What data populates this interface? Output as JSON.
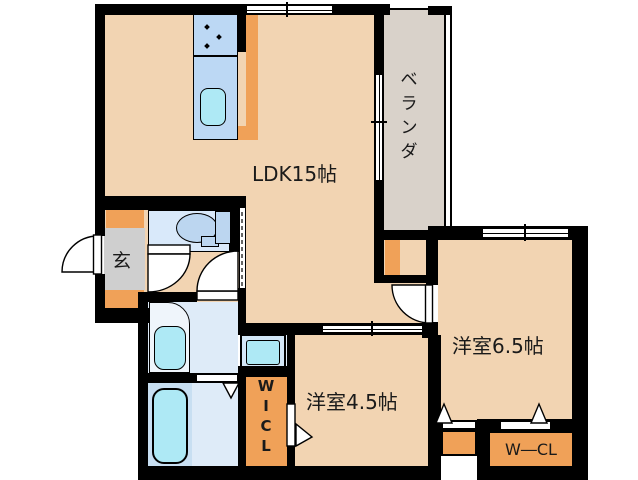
{
  "floorplan": {
    "rooms": {
      "ldk_label": "LDK15帖",
      "veranda_chars": [
        "ベ",
        "ラ",
        "ン",
        "ダ"
      ],
      "entrance_label": "玄",
      "room65_label": "洋室6.5帖",
      "room45_label": "洋室4.5帖",
      "wcl_label": "W―CL",
      "wicl_chars": [
        "W",
        "I",
        "C",
        "L"
      ]
    },
    "fixtures": [
      "kitchen-counter-with-sink",
      "toilet",
      "washbasin",
      "washing-machine-pan",
      "bathtub"
    ],
    "door_symbols": [
      "entrance-swing-door",
      "toilet-swing-door",
      "washroom-swing-door",
      "room65-swing-door",
      "wicl-folding-door",
      "bathroom-folding-door",
      "closet-folding-door-small",
      "closet-folding-door-wcl",
      "ldk-accordion-door"
    ],
    "window_symbols": [
      "ldk-top-window",
      "room65-top-window",
      "veranda-sliding-door",
      "ldk-room45-sliding-door"
    ]
  },
  "colors": {
    "floor_peach": "#F2D4B2",
    "closet_orange": "#F0A158",
    "kitchen_blue": "#BCD8F4",
    "fixture_cyan": "#AEE9F5",
    "wet_blue": "#DEEBF8",
    "veranda_gray": "#D9D2CA",
    "genkan_gray": "#CFCFCF",
    "wall_black": "#000000"
  }
}
